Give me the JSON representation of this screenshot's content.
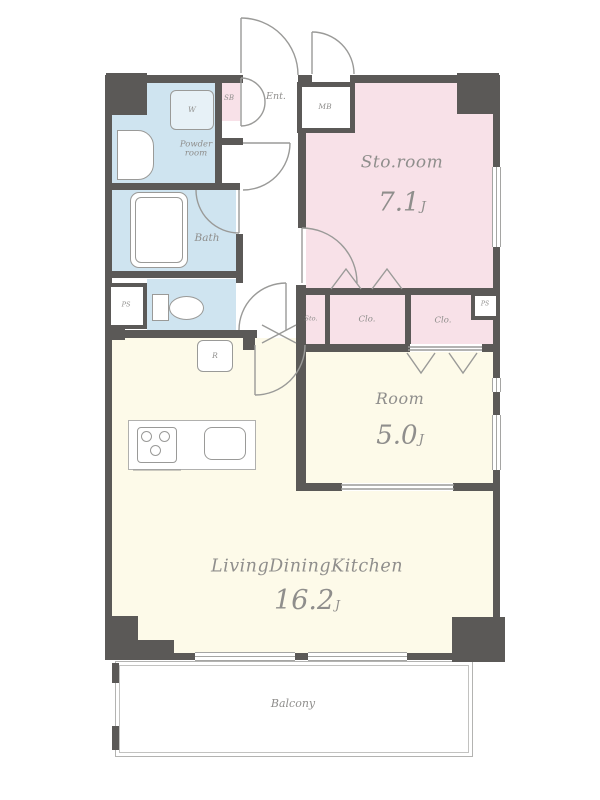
{
  "title": "apartment-floor-plan",
  "rooms": {
    "storage_room": {
      "name": "Sto.room",
      "area": "7.1",
      "unit": "J"
    },
    "bedroom": {
      "name": "Room",
      "area": "5.0",
      "unit": "J"
    },
    "living": {
      "name": "LivingDiningKitchen",
      "area": "16.2",
      "unit": "J"
    },
    "balcony": {
      "name": "Balcony"
    },
    "bath": {
      "name": "Bath"
    },
    "powder": {
      "line1": "Powder",
      "line2": "room"
    },
    "entrance": {
      "name": "Ent."
    }
  },
  "compartments": {
    "washer": "W",
    "shoe_box": "SB",
    "meter_box": "MB",
    "pipe_space_toilet": "PS",
    "pipe_space_closet": "PS",
    "hall_storage": "Sto.",
    "closet_main": "Clo.",
    "closet_second": "Clo.",
    "refrigerator": "R"
  },
  "colors": {
    "wall": "#5b5957",
    "water_rooms": "#cfe4f0",
    "storage_room_fill": "#f8e1e8",
    "living_fill": "#fdfae9",
    "label_text": "#8f8e8c"
  }
}
